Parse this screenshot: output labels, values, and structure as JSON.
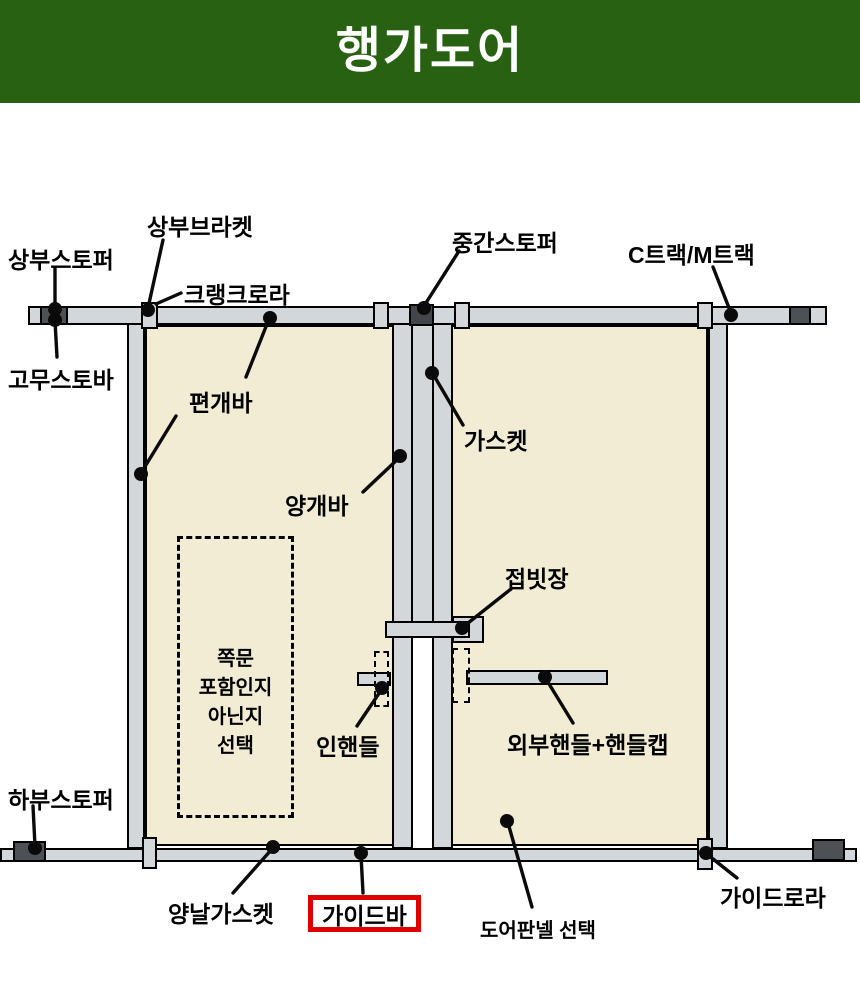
{
  "header": {
    "title": "행가도어",
    "bg_color": "#276111",
    "text_color": "#ffffff"
  },
  "diagram": {
    "colors": {
      "bar_fill": "#d3d7da",
      "panel_fill": "#f2ecd4",
      "dark_block": "#4d5155",
      "middle_stopper_block": "#42464a",
      "outline": "#000000",
      "highlight_red": "#dd0000"
    },
    "labels": {
      "top_stopper": "상부스토퍼",
      "top_bracket": "상부브라켓",
      "crank_roller": "크랭크로라",
      "rubber_stopper_bar": "고무스토바",
      "single_door_bar": "편개바",
      "middle_stopper": "중간스토퍼",
      "track": "C트랙/M트랙",
      "gasket": "가스켓",
      "double_door_bar": "양개바",
      "folding_latch": "접빗장",
      "inner_handle": "인핸들",
      "outer_handle": "외부핸들+핸들캡",
      "bottom_stopper": "하부스토퍼",
      "double_edge_gasket": "양날가스켓",
      "guide_bar": "가이드바",
      "door_panel_select": "도어판넬 선택",
      "guide_roller": "가이드로라",
      "side_door_note_lines": [
        "쪽문",
        "포함인지",
        "아닌지",
        "선택"
      ]
    }
  }
}
